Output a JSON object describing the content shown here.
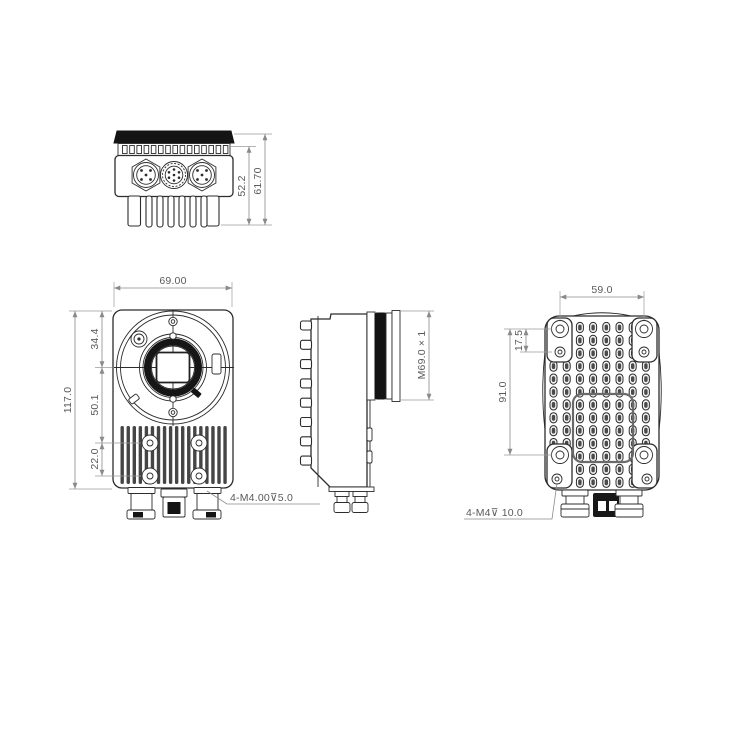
{
  "views": {
    "bottom_view": {
      "dims": {
        "body_height": "52.2",
        "overall_height": "61.70"
      }
    },
    "front_view": {
      "dims": {
        "width": "69.00",
        "overall_height": "117.0",
        "top_to_lens_center": "34.4",
        "lens_center_to_screws": "50.1",
        "screw_row_spacing": "22.0",
        "mount_thread_note": "4-M4.00⊽5.0"
      }
    },
    "side_view": {
      "dims": {
        "lens_ring_thread": "M69.0 × 1"
      }
    },
    "rear_view": {
      "dims": {
        "screw_span_width": "59.0",
        "screw_pair_offset": "17.5",
        "screw_span_height": "91.0",
        "mount_thread_note": "4-M4⊽ 10.0"
      }
    }
  },
  "colors": {
    "outline": "#2c2c2c",
    "dark_fill": "#141414",
    "dim_line": "#8a8a8a",
    "dim_text": "#5a5a5a",
    "background": "#ffffff"
  }
}
